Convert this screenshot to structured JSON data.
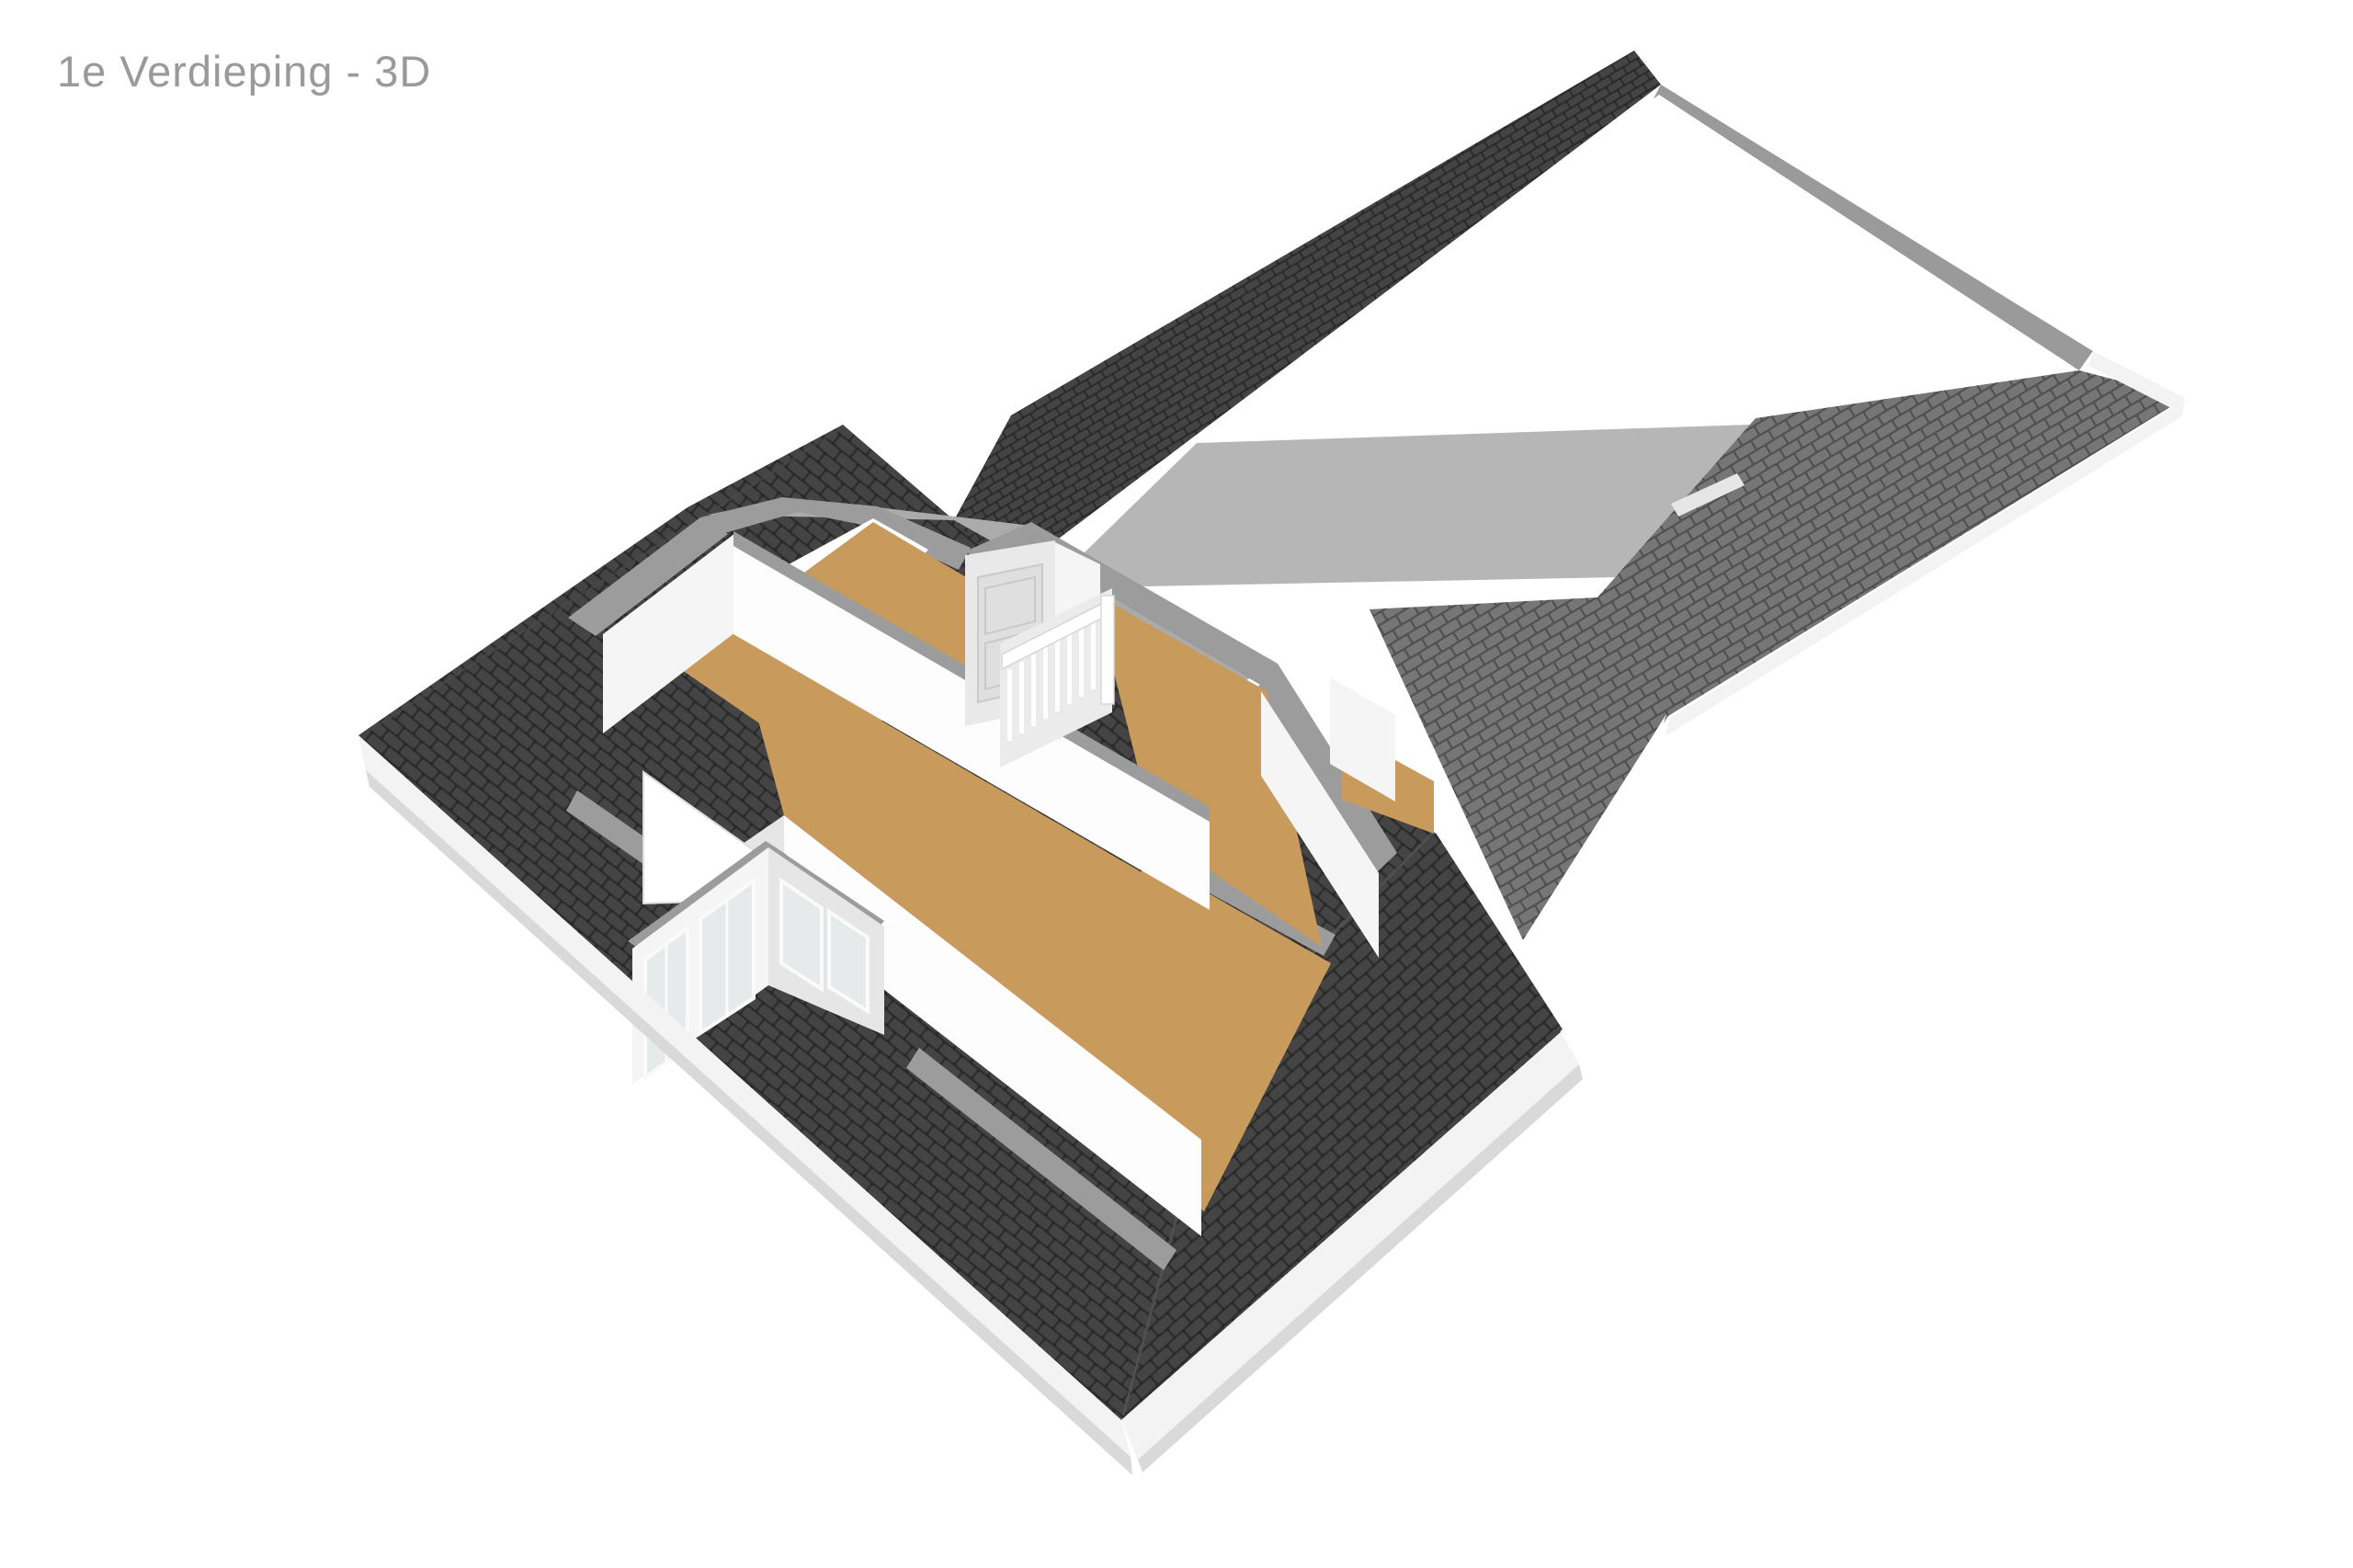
{
  "header": {
    "title": "1e Verdieping - 3D"
  },
  "scene": {
    "type": "floorplan-3d-render",
    "floor_label": "1e Verdieping",
    "view_mode": "3D",
    "elements": [
      "main-hip-roof",
      "roof-wing",
      "roof-valley",
      "cut-plane-bands",
      "room-left",
      "room-center",
      "room-landing",
      "room-right-north",
      "room-right-south",
      "dormer-with-windows",
      "stair-railing",
      "closet-door",
      "eave-fascia"
    ]
  },
  "colors": {
    "background": "#ffffff",
    "title_text": "#9a9a9a",
    "dark_tile_base": "#2c2c2c",
    "dark_tile_face": "#444444",
    "dark_tile_gap": "#262626",
    "light_tile_base": "#4e4e4e",
    "light_tile_face": "#767676",
    "light_tile_gap": "#575757",
    "cut_band": "#9c9c9c",
    "inner_slope_gray": "#ababab",
    "wing_plane_gray": "#b6b6b6",
    "gable_strip": "#9a9a9a",
    "wall_white": "#f5f5f5",
    "wall_bright": "#fdfdfd",
    "wall_shaded": "#e6e6e6",
    "floor_tan": "#c89a5c",
    "fascia_white": "#f3f3f3",
    "fascia_shadow": "#d9d9d9",
    "glass": "#e7eaea",
    "stair_void": "#ffffff",
    "rail_backdrop": "#ebebeb",
    "closet_face": "#e9e9e9",
    "closet_door": "#dfdfdf"
  }
}
